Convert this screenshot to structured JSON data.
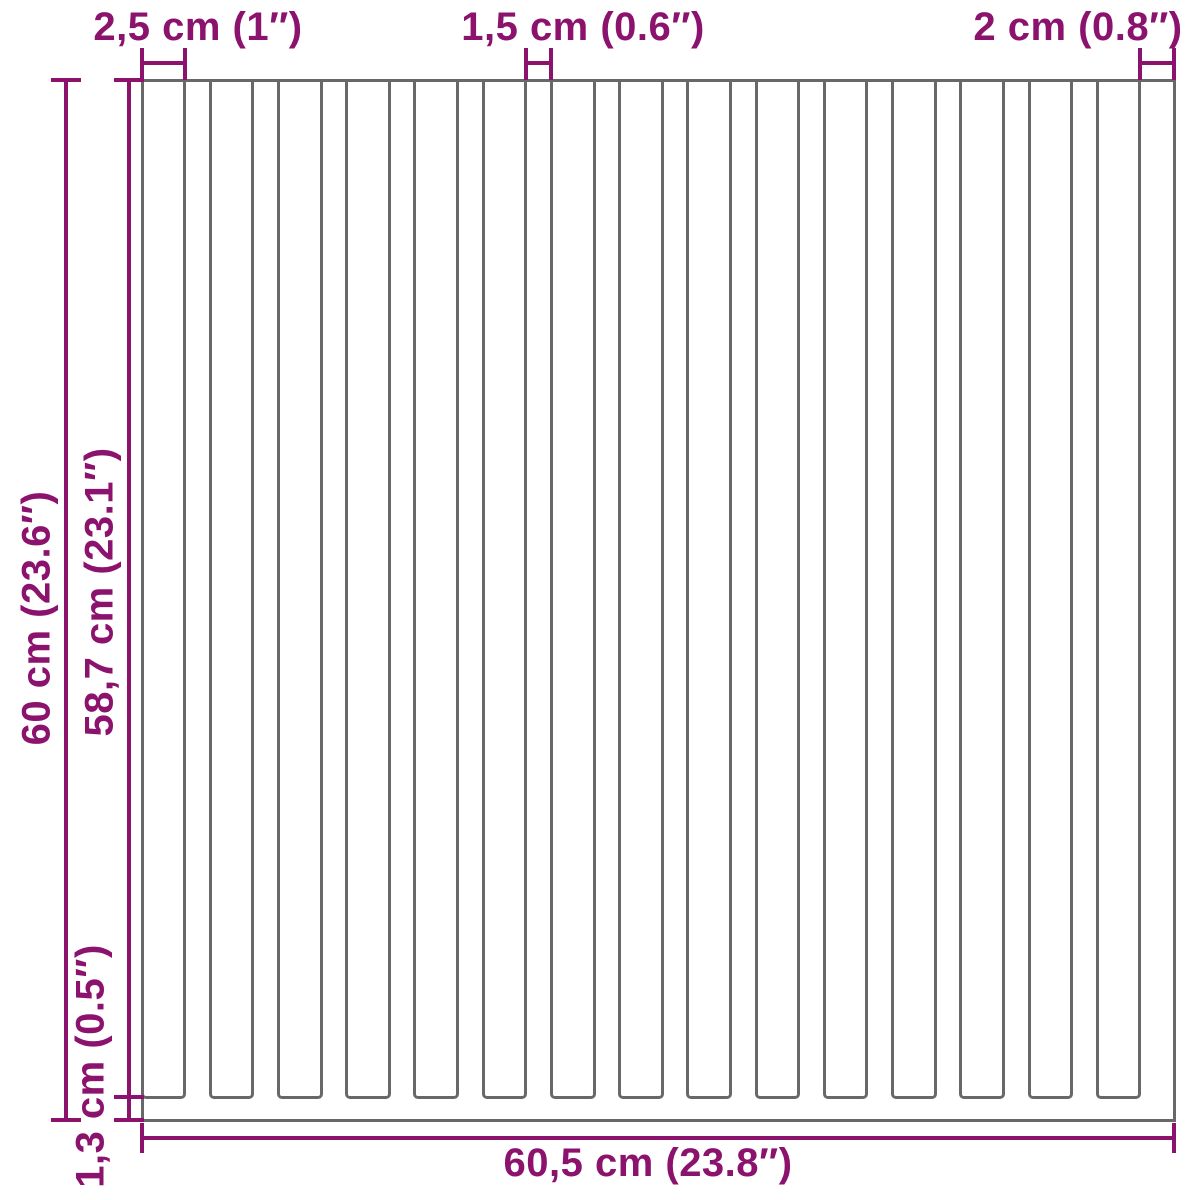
{
  "diagram": {
    "colors": {
      "accent": "#8b136e",
      "line": "#686868",
      "background": "#ffffff"
    },
    "labels": {
      "top_left": "2,5 cm (1″)",
      "top_middle": "1,5 cm (0.6″)",
      "top_right": "2 cm (0.8″)",
      "left_outer": "60 cm (23.6″)",
      "left_inner": "58,7 cm (23.1″)",
      "bottom_left": "1,3 cm (0.5″)",
      "bottom": "60,5 cm (23.8″)"
    },
    "panel": {
      "width_cm": 60.5,
      "height_cm": 60,
      "slat_length_cm": 58.7,
      "bottom_rail_cm": 1.3,
      "wide_slat_cm": 2.5,
      "narrow_gap_cm": 1.5,
      "end_slat_cm": 2,
      "wide_slat_count": 15,
      "narrow_gap_count": 14
    }
  }
}
